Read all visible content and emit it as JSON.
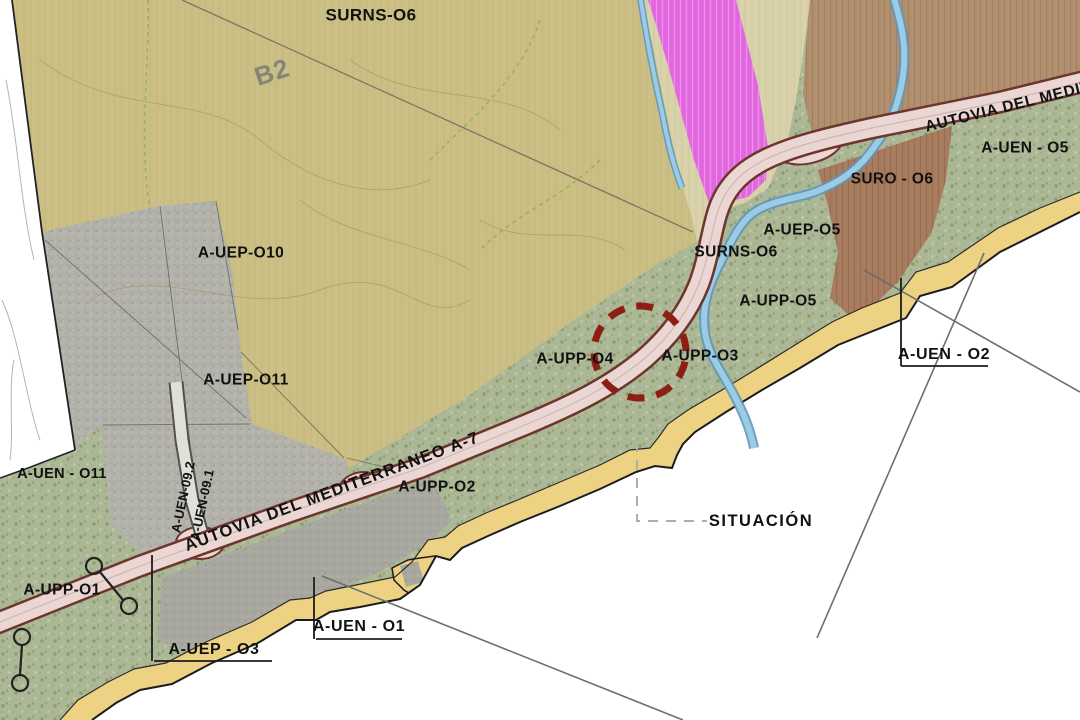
{
  "map": {
    "description": "Urban zoning situation plan along the Mediterranean coast",
    "zones": {
      "surns_top": "SURNS-O6",
      "b2": "B2",
      "suro_o6": "SURO - O6",
      "a_uen_o5": "A-UEN - O5",
      "a_uep_o5": "A-UEP-O5",
      "surns_mid": "SURNS-O6",
      "a_upp_o5": "A-UPP-O5",
      "a_uep_o10": "A-UEP-O10",
      "a_uep_o11": "A-UEP-O11",
      "a_upp_o4": "A-UPP-O4",
      "a_upp_o3": "A-UPP-O3",
      "a_uen_o11": "A-UEN - O11",
      "a_uen_09_2": "A-UEN-09.2",
      "a_uen_09_1": "A-UEN-09.1",
      "a_upp_o2": "A-UPP-O2",
      "a_upp_o1": "A-UPP-O1"
    },
    "roads": {
      "autovia_main": "AUTOVIA DEL MEDITERRANEO A-7",
      "autovia_ne": "AUTOVIA DEL MEDIT"
    },
    "callouts": {
      "situacion": "SITUACIÓN",
      "a_uen_o2": "A-UEN - O2",
      "a_uen_o1": "A-UEN - O1",
      "a_uep_o3": "A-UEP - O3"
    }
  },
  "colors": {
    "label_text": "#111111",
    "sea_paper": "#ffffff",
    "vegetation_green": "#abb795",
    "rustic_olive": "#cbbf85",
    "pale_khaki": "#d9d2ab",
    "magenta_zone": "#e167df",
    "brown_zone": "#a87c5e",
    "brown_zone_light": "#b1906f",
    "urban_gray": "#b5b5ad",
    "beach_sand": "#eed284",
    "highway_fill": "#ead7d3",
    "highway_casing": "#6e352c",
    "river_blue": "#9ccbe6",
    "river_blue_dark": "#5f97ba",
    "marker_circle_red": "#8e1d12",
    "survey_line_gray": "#6e6e6e"
  }
}
